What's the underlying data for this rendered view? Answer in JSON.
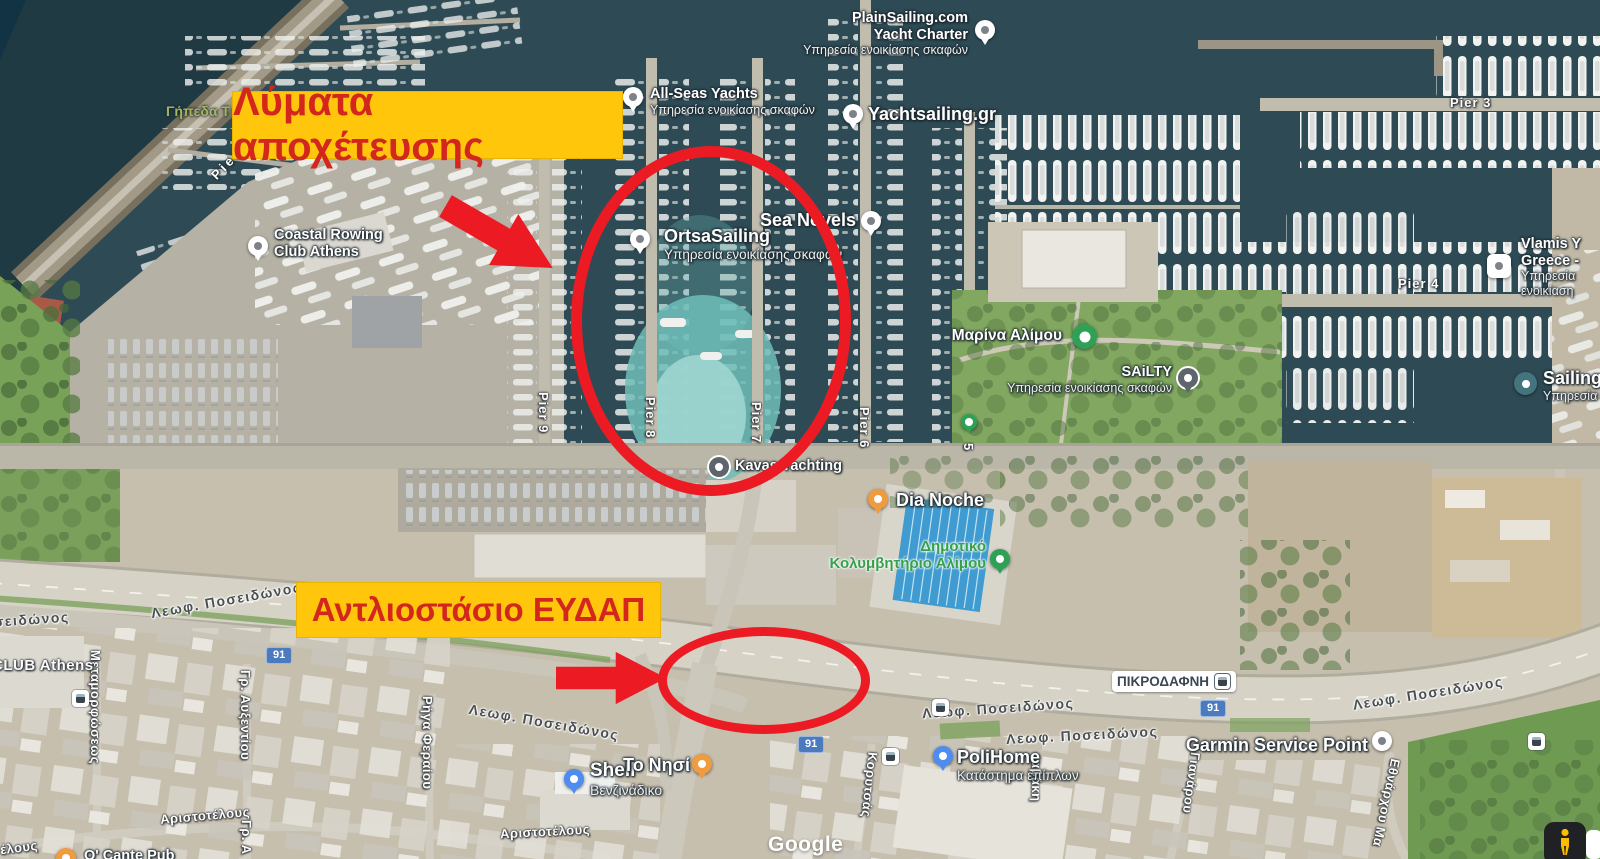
{
  "annotations": {
    "label_top": "Λύματα αποχέτευσης",
    "label_bottom": "Αντλιοστάσιο ΕΥΔΑΠ",
    "highlight_bg_color": "#ffc60b",
    "highlight_text_color": "#d3271d",
    "marker_color": "#ec1b23"
  },
  "pois": [
    {
      "name": "PlainSailing.com",
      "name2": "Yacht Charter",
      "subtitle": "Υπηρεσία ενοικίασης σκαφών"
    },
    {
      "name": "All-Seas Yachts",
      "subtitle": "Υπηρεσία ενοικίασης σκαφών"
    },
    {
      "name": "Yachtsailing.gr"
    },
    {
      "name": "OrtsaSailing",
      "subtitle": "Υπηρεσία ενοικίασης σκαφών"
    },
    {
      "name": "Sea Novels"
    },
    {
      "name": "Coastal Rowing",
      "name2": "Club Athens"
    },
    {
      "name": "Μαρίνα Αλίμου"
    },
    {
      "name": "SAiLTY",
      "subtitle": "Υπηρεσία ενοικίασης σκαφών"
    },
    {
      "name": "Kavas Yachting"
    },
    {
      "name": "Vlamis Y",
      "name2": "Greece -",
      "subtitle": "Υπηρεσία",
      "subtitle2": "ενοικίαση"
    },
    {
      "name": "SailingCo",
      "subtitle": "Υπηρεσία ε"
    },
    {
      "name": "Dia Noche"
    },
    {
      "name": "Δημοτικό",
      "name2": "Κολυμβητήριο Αλίμου"
    },
    {
      "name": "PoliHome",
      "subtitle": "Κατάστημα επίπλων"
    },
    {
      "name": "Shell",
      "subtitle": "Βενζινάδικο"
    },
    {
      "name": "Το Νησί"
    },
    {
      "name": "Garmin Service Point"
    },
    {
      "name": "ΠΙΚΡΟΔΑΦΝΗ"
    },
    {
      "name": "O' Cante Pub"
    }
  ],
  "piers": {
    "pier_e": "Pier E",
    "pier_9": "Pier 9",
    "pier_8": "Pier 8",
    "pier_7": "Pier 7",
    "pier_6": "Pier 6",
    "pier_5": "5",
    "pier_4": "Pier 4",
    "pier_3": "Pier 3"
  },
  "roads": {
    "name": "Λεωφ. Ποσειδώνος",
    "name_partial": "Ποσειδώνος",
    "route_number": "91"
  },
  "streets": {
    "s1": "Μεταμορφώσεως",
    "s2": "Γρ. Αυξεντίου",
    "s3": "Γρ. Α",
    "s4": "Ρήγα Φεραίου",
    "s5": "Κορυτσάς",
    "s6": "αβάκη",
    "s7": "Γιανάρου",
    "s8": "Εθνάρχου Μα",
    "aristotelous": "Αριστοτέλους",
    "aristotelous_partial": "έλους"
  },
  "areas": {
    "fields": "Γήπεδα Τ",
    "club": "CLUB Athens"
  },
  "watermark": {
    "logo": "Google"
  }
}
